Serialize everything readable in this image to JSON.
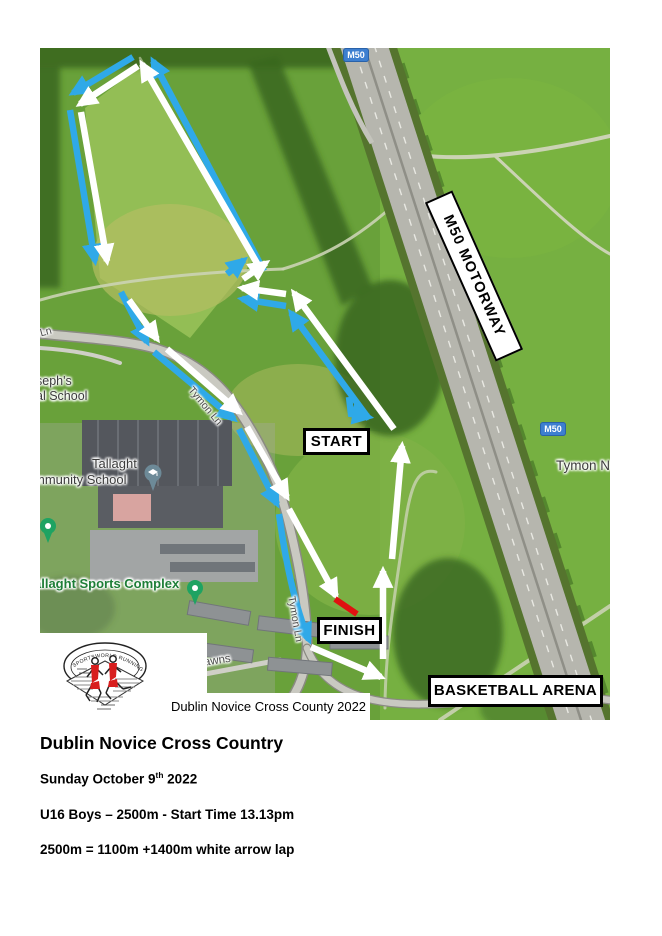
{
  "map": {
    "start_label": "START",
    "finish_label": "FINISH",
    "motorway_label": "M50 MOTORWAY",
    "arena_label": "BASKETBALL ARENA",
    "m50_shield": "M50",
    "caption": "Dublin Novice Cross County 2022",
    "labels": {
      "school1_line1": "seph's",
      "school1_line2": "al School",
      "school2_line1": "Tallaght",
      "school2_line2": "mmunity School",
      "sports_complex": "allaght Sports Complex",
      "road_tymon": "Tymon Ln",
      "road_castle": "Castle Lawns",
      "area_tymon_n": "Tymon N",
      "road_fragment": "Ln"
    },
    "colors": {
      "course_blue": "#2FA9E8",
      "course_white": "#FFFFFF",
      "finish_red": "#E01010",
      "shield_blue": "#3D7FD0"
    }
  },
  "logo": {
    "club_name": "SPORTSWORLD RUNNING CLUB"
  },
  "details": {
    "title": "Dublin Novice Cross Country",
    "date_prefix": "Sunday October 9",
    "date_sup": "th",
    "date_suffix": " 2022",
    "race_line": "U16 Boys  – 2500m - Start Time 13.13pm",
    "lap_line": "2500m = 1100m +1400m white arrow lap"
  }
}
